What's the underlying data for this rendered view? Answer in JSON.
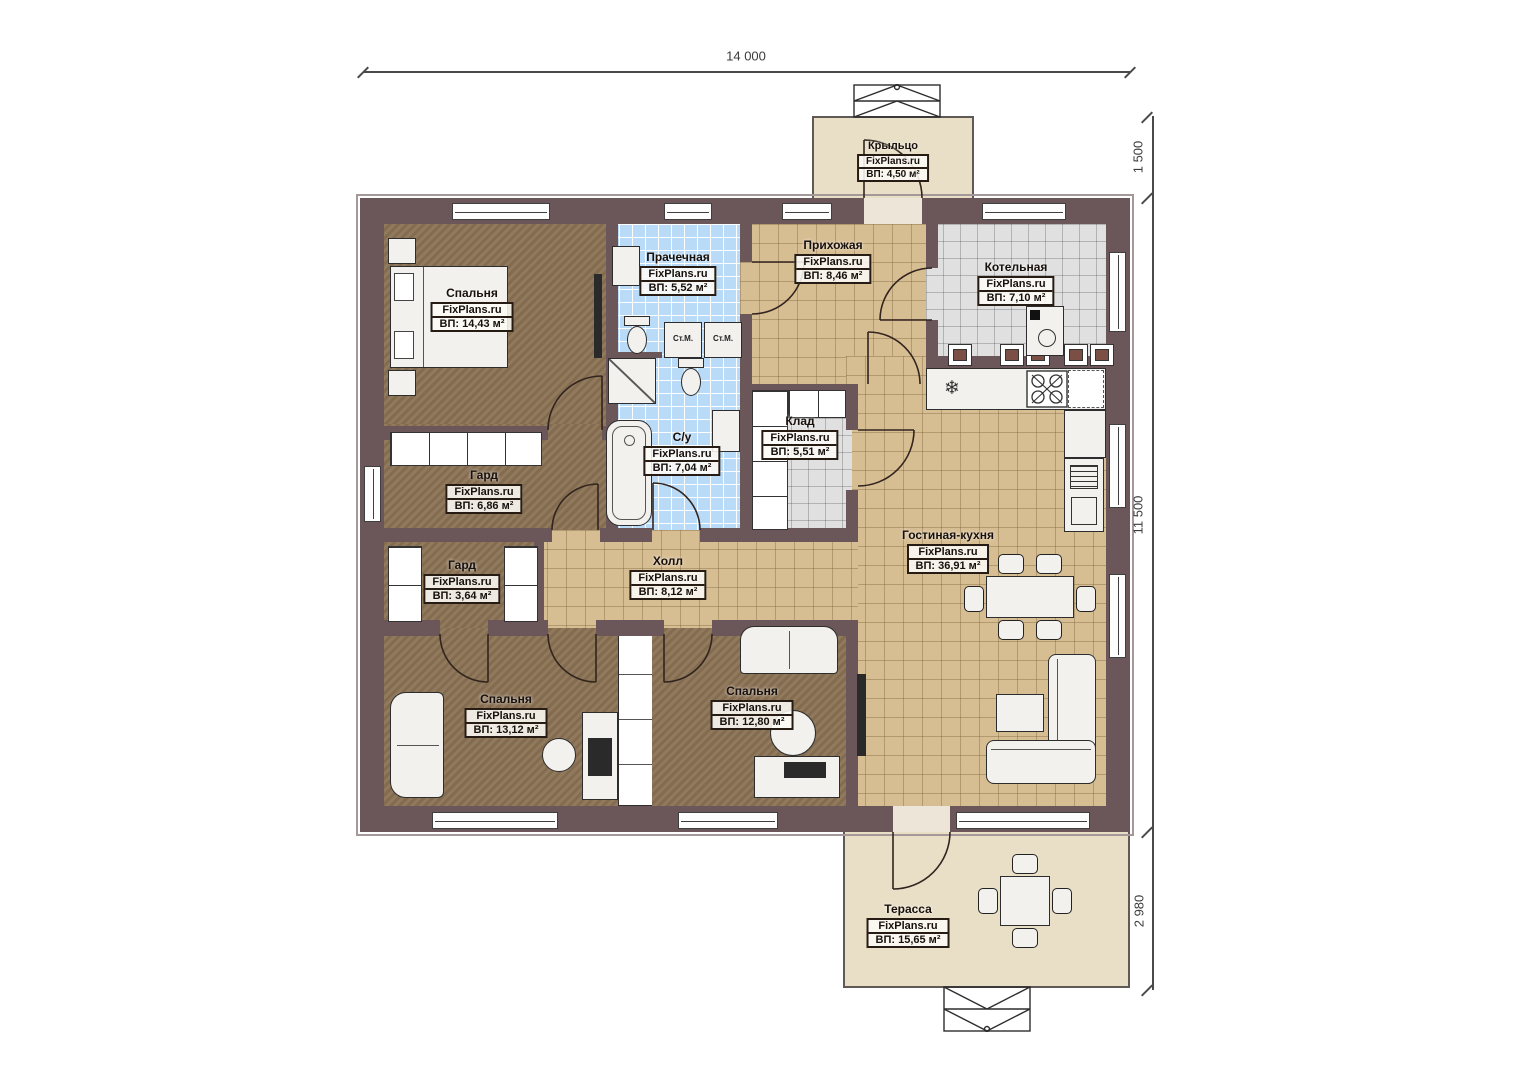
{
  "plan_title": "Floor plan",
  "brand": "FixPlans.ru",
  "dimensions": {
    "top_width": "14 000",
    "porch_depth": "1 500",
    "house_depth": "11 500",
    "terrace_depth": "2 980"
  },
  "rooms": [
    {
      "key": "porch",
      "name": "Крыльцо",
      "brand": "FixPlans.ru",
      "area": "ВП: 4,50 м²"
    },
    {
      "key": "bedroom-1",
      "name": "Спальня",
      "brand": "FixPlans.ru",
      "area": "ВП: 14,43 м²"
    },
    {
      "key": "laundry",
      "name": "Прачечная",
      "brand": "FixPlans.ru",
      "area": "ВП: 5,52 м²"
    },
    {
      "key": "entry-hall",
      "name": "Прихожая",
      "brand": "FixPlans.ru",
      "area": "ВП: 8,46 м²"
    },
    {
      "key": "boiler-room",
      "name": "Котельная",
      "brand": "FixPlans.ru",
      "area": "ВП: 7,10 м²"
    },
    {
      "key": "wardrobe-1",
      "name": "Гард",
      "brand": "FixPlans.ru",
      "area": "ВП: 6,86 м²"
    },
    {
      "key": "bathroom",
      "name": "С/у",
      "brand": "FixPlans.ru",
      "area": "ВП: 7,04 м²"
    },
    {
      "key": "storage",
      "name": "Клад",
      "brand": "FixPlans.ru",
      "area": "ВП: 5,51 м²"
    },
    {
      "key": "wardrobe-2",
      "name": "Гард",
      "brand": "FixPlans.ru",
      "area": "ВП: 3,64 м²"
    },
    {
      "key": "hall",
      "name": "Холл",
      "brand": "FixPlans.ru",
      "area": "ВП: 8,12 м²"
    },
    {
      "key": "living-kitchen",
      "name": "Гостиная-кухня",
      "brand": "FixPlans.ru",
      "area": "ВП: 36,91 м²"
    },
    {
      "key": "bedroom-2",
      "name": "Спальня",
      "brand": "FixPlans.ru",
      "area": "ВП: 13,12 м²"
    },
    {
      "key": "bedroom-3",
      "name": "Спальня",
      "brand": "FixPlans.ru",
      "area": "ВП: 12,80 м²"
    },
    {
      "key": "terrace",
      "name": "Терасса",
      "brand": "FixPlans.ru",
      "area": "ВП: 15,65 м²"
    }
  ],
  "labels": {
    "washer": "Ст.М."
  },
  "colors": {
    "wall": "#6b5659",
    "floor_wood": "#8b7254",
    "tile_beige": "#d7bd92",
    "tile_blue": "#badbf7",
    "tile_gray": "#e0e0e0",
    "deck": "#e9dfc7"
  }
}
